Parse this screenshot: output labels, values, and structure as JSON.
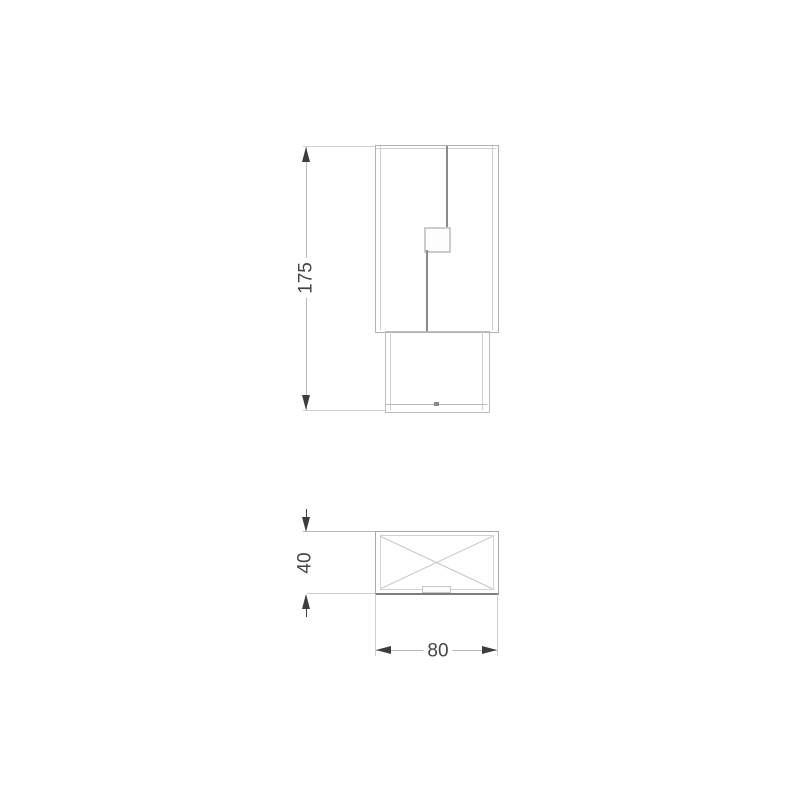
{
  "drawing": {
    "type": "technical-dimension-drawing",
    "views": {
      "front_view": "front elevation of cabinet with offset door gap, handle recess and plinth base",
      "plan_view": "top view rectangle with diagonal cross"
    },
    "dimensions": {
      "height": {
        "label": "175"
      },
      "depth": {
        "label": "40"
      },
      "width": {
        "label": "80"
      }
    },
    "colors": {
      "background": "#ffffff",
      "line_light": "#cfcfcf",
      "line_medium": "#b8b8b8",
      "line_dark": "#8a8a8a",
      "outline_plan_bottom": "#7d7d7d",
      "arrow": "#3d3d3d",
      "dimension_text": "#454545"
    }
  }
}
